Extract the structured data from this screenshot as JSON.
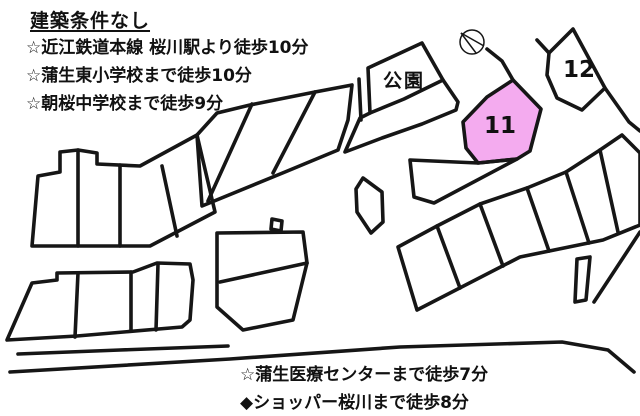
{
  "title": "建築条件なし",
  "bullets": [
    "☆近江鉄道本線 桜川駅より徒歩10分",
    "☆蒲生東小学校まで徒歩10分",
    "☆朝桜中学校まで徒歩9分"
  ],
  "bottom_notes": [
    "☆蒲生医療センターまで徒歩7分",
    "◆ショッパー桜川まで徒歩8分"
  ],
  "map": {
    "line_color": "#161616",
    "highlight_color": "#F4ABEF",
    "labels": [
      {
        "id": "park",
        "text": "公園"
      },
      {
        "id": "plot-11",
        "text": "11"
      },
      {
        "id": "plot-12",
        "text": "12"
      }
    ],
    "compass": {
      "cx": 472,
      "cy": 42,
      "r": 12,
      "chords": [
        [
          461,
          33,
          484,
          46
        ],
        [
          461,
          33,
          476,
          53
        ]
      ]
    },
    "shapes": [
      {
        "name": "block-a-outline",
        "d": "M38,176 L60,172 L60,152 L78,150 L97,153 L97,164 L140,166 L197,135 L215,212 L150,246 L32,246 Z"
      },
      {
        "name": "block-a-dividers",
        "d": "M78,150 L78,246 M120,165 L120,246 M162,166 L177,236"
      },
      {
        "name": "strip-block-upper",
        "d": "M197,135 L217,113 L250,105 L315,92 L352,85 L348,120 L338,150 L285,172 L202,206 Z"
      },
      {
        "name": "strip-block-upper-dividers",
        "d": "M252,104 L208,201 M315,92 L273,173"
      },
      {
        "name": "park-block",
        "d": "M422,43 L368,68 L370,113 L360,118 L345,152 L382,138 L422,124 L456,110 L458,102 L443,80 Z"
      },
      {
        "name": "park-block-divider",
        "d": "M443,80 L404,99 L370,113"
      },
      {
        "name": "park-sliver-line",
        "d": "M359,79 L361,120"
      },
      {
        "name": "plot-11-polygon",
        "d": "M513,80 L487,97 L463,122 L466,148 L478,163 L517,159 L530,151 L541,109 Z",
        "fill": "#F4ABEF"
      },
      {
        "name": "plot-11-stem",
        "d": "M513,80 L502,61 L487,49"
      },
      {
        "name": "plot-12-polygon",
        "d": "M573,29 L549,53 L547,75 L557,98 L582,110 L605,88 Z"
      },
      {
        "name": "plot-12-tick",
        "d": "M549,53 L537,40"
      },
      {
        "name": "road-edge-right-of-12",
        "d": "M605,88 L629,122 L640,131"
      },
      {
        "name": "mid-pentagon-parcel",
        "d": "M363,178 L382,192 L383,222 L371,233 L357,212 L356,189 Z"
      },
      {
        "name": "parcel-under-11",
        "d": "M410,160 L478,163 L517,159 L434,203 L414,197 Z"
      },
      {
        "name": "strip-block-lower",
        "d": "M398,247 L437,226 L480,204 L527,188 L566,172 L600,150 L622,135 L640,153 L640,225 L603,240 L520,257 L417,310 Z"
      },
      {
        "name": "strip-block-lower-dividers",
        "d": "M437,226 L460,288 M480,204 L503,266 M527,188 L549,251 M566,172 L589,243 M600,150 L618,232"
      },
      {
        "name": "mid-lower-block",
        "d": "M217,233 L303,232 L307,263 L293,320 L243,330 L217,307 Z"
      },
      {
        "name": "mid-lower-block-divider",
        "d": "M220,282 L307,263"
      },
      {
        "name": "road-notch-square",
        "d": "M271,229 L272,219 L282,221 L281,231 Z"
      },
      {
        "name": "bottom-left-block",
        "d": "M32,283 L57,280 L57,273 L133,272 L157,263 L190,264 L193,280 L190,320 L182,327 L77,336 L7,340 Z"
      },
      {
        "name": "bottom-left-block-dividers",
        "d": "M78,273 L75,337 M131,272 L131,331 M158,264 L156,330"
      },
      {
        "name": "bottom-road-short-line",
        "d": "M18,354 L120,350 L228,346"
      },
      {
        "name": "bottom-road-long-line",
        "d": "M10,372 L230,359 L400,347 L562,342 L608,350 L634,372"
      },
      {
        "name": "right-road-edge",
        "d": "M640,232 L594,302"
      },
      {
        "name": "stub-parcel",
        "d": "M577,259 L590,257 L586,300 L575,302 Z"
      }
    ]
  }
}
